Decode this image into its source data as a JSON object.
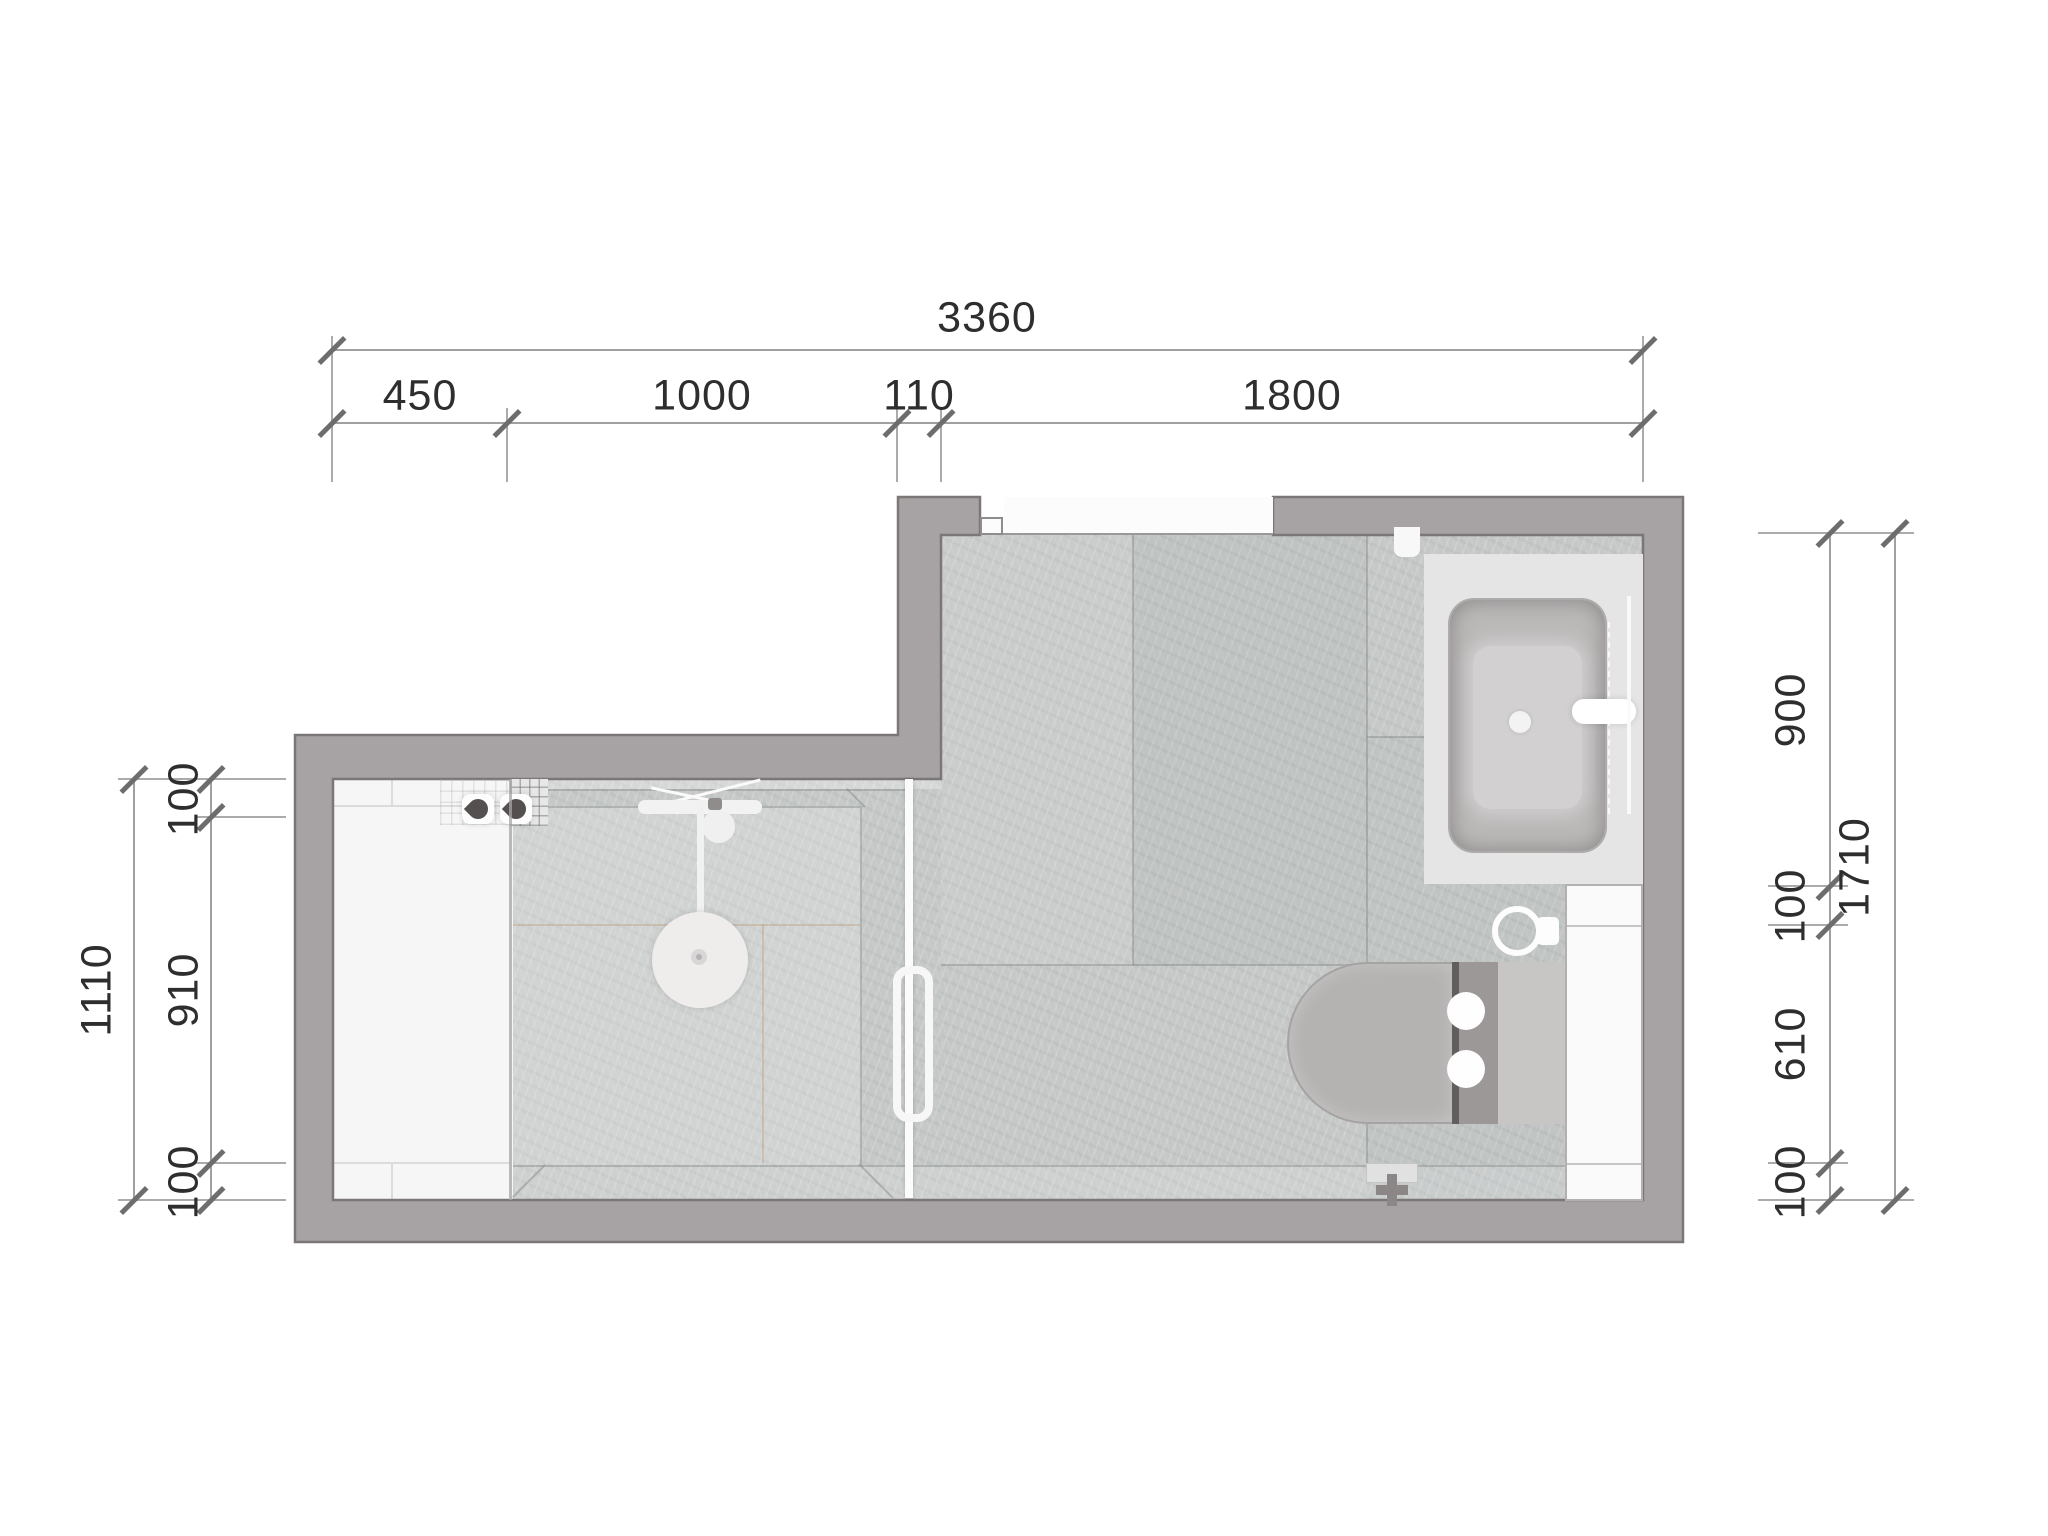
{
  "page": {
    "type": "architectural-floor-plan",
    "subject": "bathroom plan view"
  },
  "dimensions": {
    "top": {
      "total": "3360",
      "segments": [
        "450",
        "1000",
        "110",
        "1800"
      ]
    },
    "left": {
      "total": "1110",
      "segments": [
        "100",
        "910",
        "100"
      ]
    },
    "right": {
      "total": "1710",
      "segments": [
        "900",
        "100",
        "610",
        "100"
      ]
    }
  },
  "fixtures": {
    "shower": "walk-in-shower-with-rain-head",
    "glass_door": "shower-glass-door",
    "mixer": "shower-mixer-handles",
    "niche": "mosaic-tile-niche",
    "bathtub": "bathtub-on-platform-with-faucet",
    "toilet": "wall-hung-toilet-with-cistern",
    "side_unit": "storage-ledge",
    "towel_ring": "towel-ring",
    "floor_drain": "floor-drain"
  },
  "colors": {
    "wall": "#a7a3a4",
    "wall_outline": "#7b7777",
    "tile": "#c5c8c7",
    "shower_zone": "#f7f6f6",
    "fixture_light": "#f2f1f0",
    "dim_line": "#a0a0a0",
    "dim_text": "#2e2e2e",
    "background": "#ffffff"
  }
}
